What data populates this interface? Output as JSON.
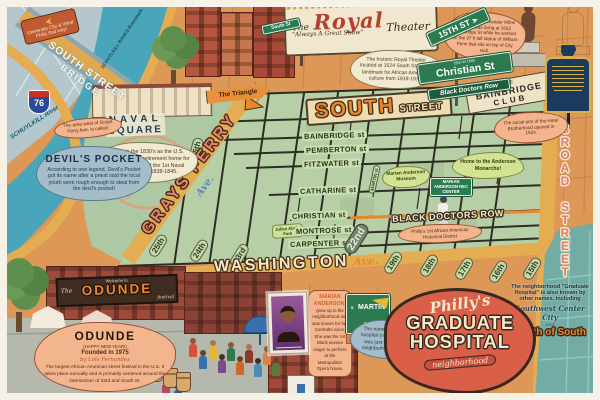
{
  "title": "Philly's Graduate Hospital neighborhood illustrated map",
  "corner_sign": {
    "text": "University City & West Philly that way!"
  },
  "bridge": {
    "line1": "SOUTH STREET",
    "line2": "BRIDGE"
  },
  "river": {
    "boardwalk": "SCHUYLKILL BANKS Boardwalk",
    "name": "SCHUYLKILL River",
    "highway_shield": "76"
  },
  "naval_square": {
    "title1": "NAVAL",
    "title2": "SQUARE",
    "note": "Begun in the 1830's as the U.S. Naval Asylum, a retirement home for sailors and hosted the 1st Naval Academy from 1838-1845."
  },
  "devils_pocket": {
    "intro": "The area west of Grays Ferry Ave. is called:",
    "title": "DEVIL'S POCKET",
    "note": "According to one legend, Devil's Pocket got its name after a priest said the local youth were rough enough to steal from the devil's pocket!"
  },
  "grays_ferry": {
    "name": "GRAYS FERRY",
    "suffix": "Ave."
  },
  "triangle": {
    "label": "The Triangle"
  },
  "royal_theater": {
    "the": "The",
    "name": "Royal",
    "tagline": "\"Always A Great Show\"",
    "word": "Theater",
    "note": "The historic Royal Theater located at 1524 South St. was a landmark for African American culture from 1919-1970."
  },
  "street_signs": {
    "fifteenth": "15TH ST",
    "christian_small": "1500 W 1600",
    "christian": "Christian St",
    "black_doctors_row": "Black Doctors Row",
    "mini_south": "South St",
    "martin": {
      "prefix": "S",
      "name": "MARTIN ST",
      "below": "MARIAN ANDERSON WAY"
    }
  },
  "south_street": {
    "word1": "SOUTH",
    "word2": "STREET"
  },
  "calder_note": "The sculptor Alexander Milne Calder was living at 1622 Bainbridge St while he worked on the 37 ft tall statue of William Penn that sits on top of City Hall.",
  "bainbridge_club": {
    "line1": "THE",
    "line2": "BAINBRIDGE",
    "line3": "CLUB",
    "note": "The social arm of the Hotel Brotherhood opened in 1924."
  },
  "grid_streets": [
    "KATER st",
    "BAINBRIDGE st",
    "PEMBERTON st",
    "FITZWATER st",
    "CATHARINE st",
    "CHRISTIAN st",
    "MONTROSE st",
    "CARPENTER st"
  ],
  "black_doctors_row": {
    "label": "BLACK DOCTORS ROW",
    "note": "Philly's 1st African American Historical District"
  },
  "numbered_streets_washington": [
    "25th",
    "24th",
    "23rd",
    "22nd",
    "19th",
    "18th",
    "17th",
    "16th",
    "15th"
  ],
  "numbered_streets_grays_ferry": [
    "25th"
  ],
  "washington_ave": {
    "name": "WASHINGTON",
    "suffix": "Ave."
  },
  "broad_street": "BROAD STREET",
  "martin_street_pill": "MARTIN st",
  "marian_anderson": {
    "museum_label": "Marian Anderson Museum",
    "rec_center_label": "MARIAN ANDERSON REC CENTER",
    "monarchs_bubble": "Home to the Anderson Monarchs!",
    "note_title": "MARIAN ANDERSON!",
    "note_body": "grew up in the neighborhood and was known for her Contralto voice. She was the 1st Black woman singer to perform at the Metropolitan Opera house."
  },
  "julian_abele_park": "Julian Abele Park",
  "hospital_name_note": "The name references a hospital (now closed) that was just outside of the neighborhood boundary.",
  "logo": {
    "phillys": "Philly's",
    "line1": "GRADUATE",
    "line2": "HOSPITAL",
    "banner": "neighborhood"
  },
  "other_names_note": {
    "intro": "The neighborhood \"Graduate Hospital\" is also known by other names, including",
    "name1": "Southwest Center City",
    "and": "and",
    "name2": "South of South"
  },
  "odunde": {
    "banner_welcome": "Welcome to",
    "banner_the": "The",
    "banner_name": "ODUNDE",
    "banner_festival": "festival",
    "note_title": "ODUNDE",
    "note_sub": "(HAPPY NEW YEAR!)",
    "founded": "Founded in 1975",
    "by": "by Lois Fernandez",
    "note_body": "The largest African American street festival in the U.S. It takes place annually and is primarily centered around the intersection of 23rd and South St."
  },
  "colors": {
    "river": "#49a5ba",
    "roads": "#e5ad52",
    "grid_green": "#b7cfa6",
    "north_orange": "#dd9757",
    "teal_east": "#72aca4",
    "logo_red": "#d95f48",
    "note_salmon": "#f2b58e",
    "sign_green": "#2c7a4f",
    "marker_blue": "#1c3a5e",
    "marker_gold": "#d4b24a"
  }
}
